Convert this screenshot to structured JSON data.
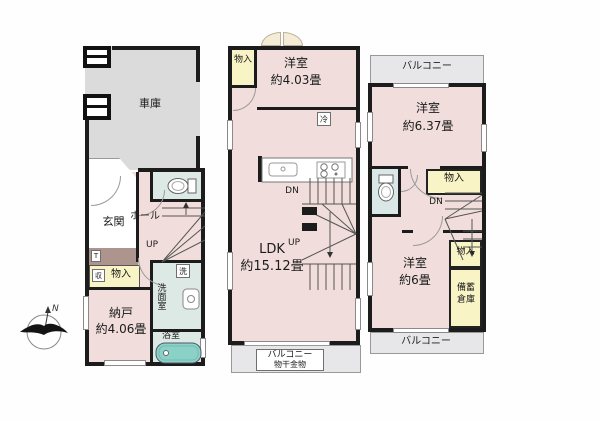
{
  "colors": {
    "wall": "#1c1c1c",
    "room_pink": "#f1dedc",
    "garage_gray": "#dbdbdb",
    "balcony_gray": "#e7e7e9",
    "wet_area_green": "#dde9e4",
    "storage_yellow": "#f8f4c5",
    "bathtub_teal": "#8ad2c8",
    "porch_brown": "#ad948c"
  },
  "floor1": {
    "garage_label": "車庫",
    "entrance_label": "玄関",
    "tile_mark": "T",
    "hall_label": "ホール",
    "stairs_up_label": "UP",
    "closet_mark": "収",
    "closet_label": "物入",
    "storeroom_label": "納戸",
    "storeroom_size": "約4.06畳",
    "washer_mark": "洗",
    "washroom_label": "洗面室",
    "bathroom_label": "浴室"
  },
  "floor2": {
    "closet_label": "物入",
    "bedroom_label": "洋室",
    "bedroom_size": "約4.03畳",
    "fridge_mark": "冷",
    "stairs_down_label": "DN",
    "stairs_up_label": "UP",
    "ldk_label": "LDK",
    "ldk_size": "約15.12畳",
    "balcony_label": "バルコニー",
    "balcony_note": "物干金物"
  },
  "floor3": {
    "balcony_top_label": "バルコニー",
    "bedroom1_label": "洋室",
    "bedroom1_size": "約6.37畳",
    "closet1_label": "物入",
    "stairs_down_label": "DN",
    "bedroom2_label": "洋室",
    "bedroom2_size": "約6畳",
    "closet2_label": "物入",
    "stockpile_line1": "備蓄",
    "stockpile_line2": "倉庫",
    "balcony_bottom_label": "バルコニー"
  },
  "compass": {
    "north_label": "N"
  }
}
